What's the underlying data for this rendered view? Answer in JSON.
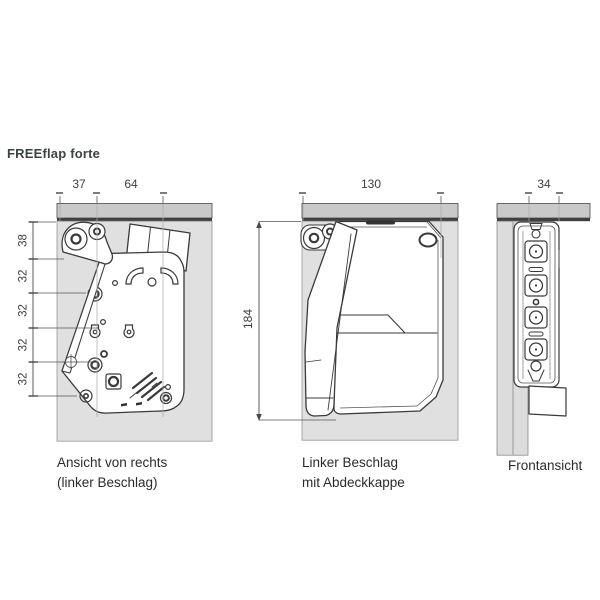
{
  "title": "FREEflap forte",
  "views": {
    "side": {
      "caption_line1": "Ansicht von rechts",
      "caption_line2": "(linker Beschlag)",
      "dim_top_left": "37",
      "dim_top_right": "64",
      "dims_left": [
        "38",
        "32",
        "32",
        "32",
        "32"
      ]
    },
    "cover": {
      "caption_line1": "Linker Beschlag",
      "caption_line2": "mit Abdeckkappe",
      "dim_width": "130",
      "dim_height": "184"
    },
    "front": {
      "caption": "Frontansicht",
      "dim_width": "34"
    }
  },
  "colors": {
    "panel_top": "#c9c9c9",
    "panel_top_edge": "#3f3f3f",
    "panel_side": "#e0e0e0",
    "panel_side_front": "#dcdcdc",
    "line": "#3a3a3a",
    "dim": "#4a4a4a",
    "title": "#3c4440",
    "caption": "#2b2b2b",
    "bg": "#ffffff"
  }
}
